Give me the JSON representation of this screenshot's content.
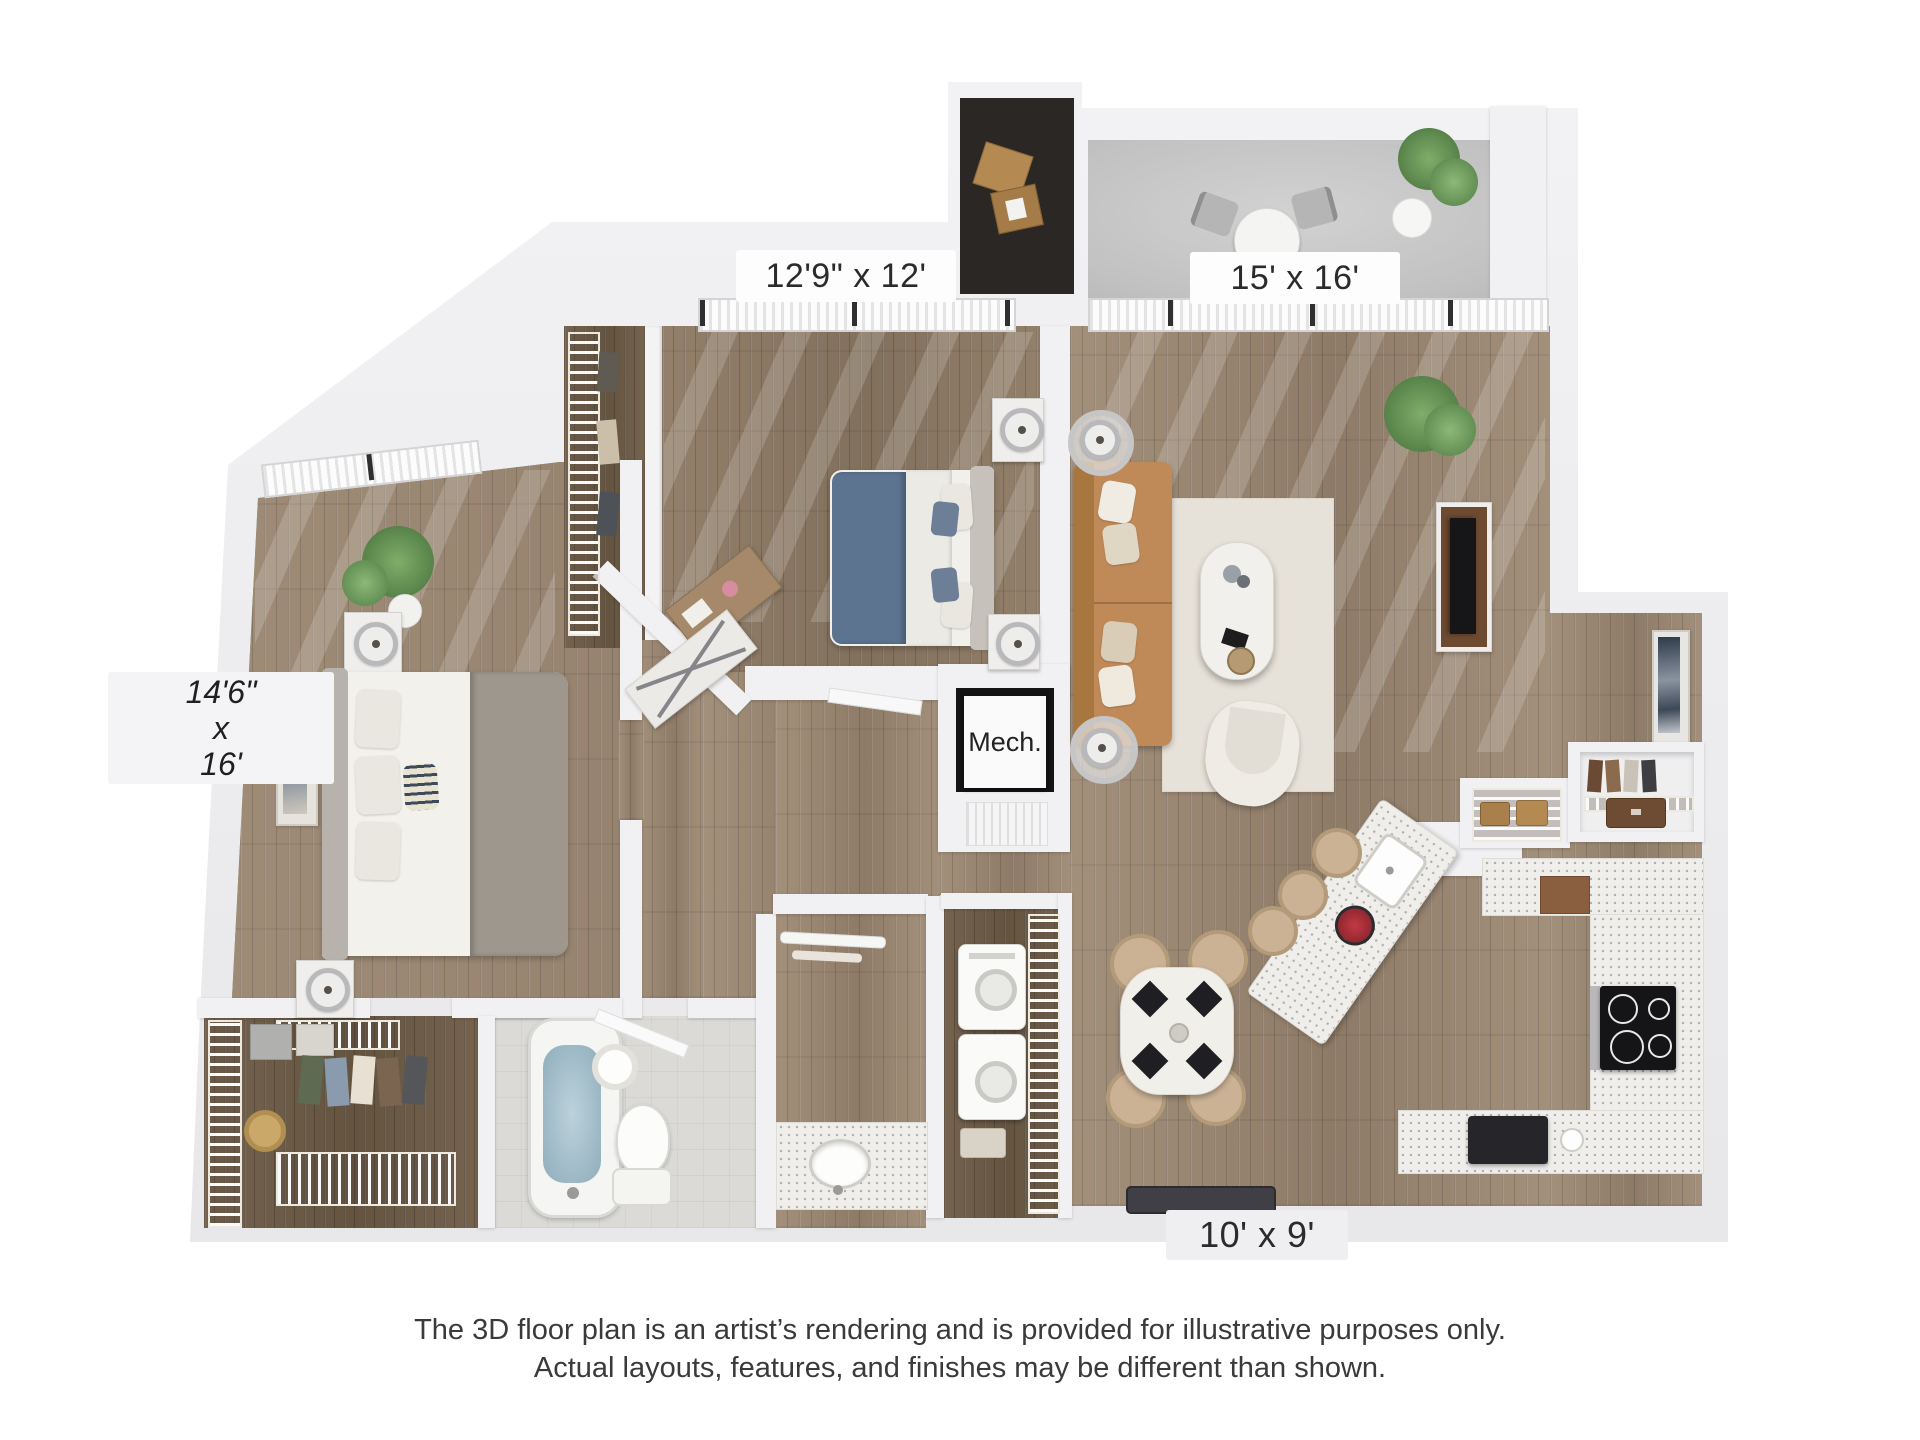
{
  "page": {
    "background": "#ffffff"
  },
  "floorplan": {
    "room_labels": {
      "bedroom2": "12'9\" x 12'",
      "living_room": "15' x 16'",
      "master_line1": "14'6\"",
      "master_line2": "x",
      "master_line3": "16'",
      "mechanical": "Mech.",
      "kitchen": "10' x 9'"
    },
    "disclaimer_line1": "The 3D floor plan is an artist’s rendering and is provided for illustrative purposes only.",
    "disclaimer_line2": "Actual layouts, features, and finishes may be different than shown.",
    "palette": {
      "wall": "#f1f1f3",
      "wood_floor": "#9a8672",
      "dark_wood": "#6e5d4d",
      "balcony_concrete": "#c7c7c7",
      "sofa_tan": "#c08a58",
      "bed_blanket_blue": "#5c7490",
      "bath_water": "#a9c3cf",
      "countertop": "#efeeeb"
    }
  }
}
